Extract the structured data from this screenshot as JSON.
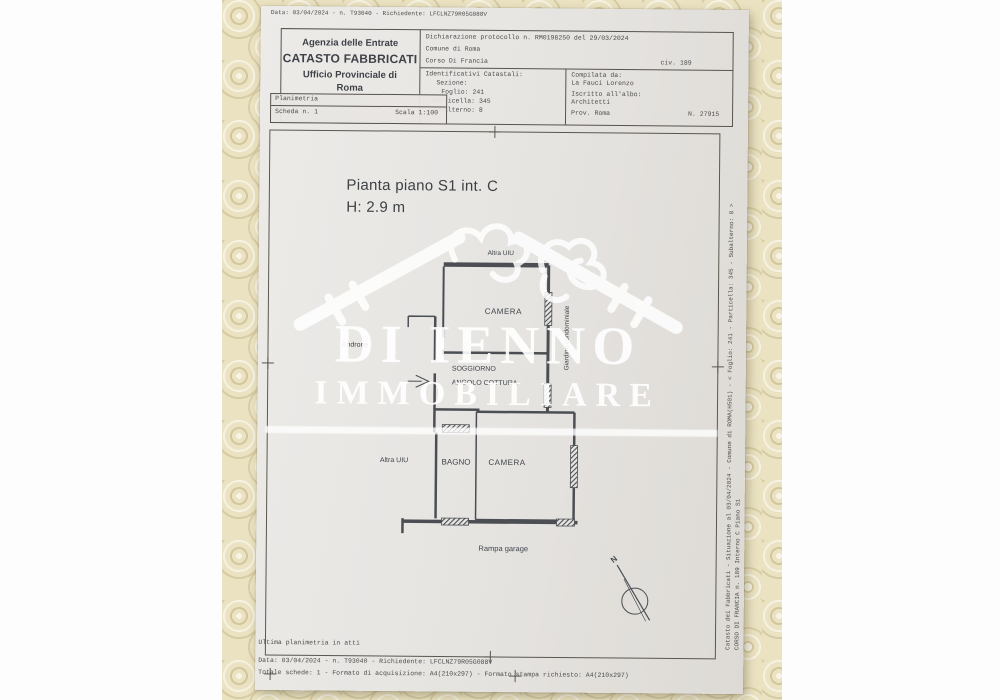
{
  "document": {
    "top_line": "Data: 03/04/2024 - n. T93040 - Richiedente: LFCLNZ79R05G088V",
    "header": {
      "agency_line1": "Agenzia delle Entrate",
      "agency_line2": "CATASTO FABBRICATI",
      "agency_line3": "Ufficio Provinciale di",
      "agency_line4": "Roma",
      "declaration": "Dichiarazione protocollo n. RM0198250 del 29/03/2024",
      "comune": "Comune di Roma",
      "street": "Corso Di Francia",
      "civic": "civ. 189",
      "cadastral_title": "Identificativi Catastali:",
      "sezione": "Sezione:",
      "foglio": "Foglio: 241",
      "particella": "Particella: 345",
      "subalterno": "Subalterno: 8",
      "compiled_title": "Compilata da:",
      "compiled_name": "La Fauci Lorenzo",
      "albo_label": "Iscritto all'albo:",
      "albo_value": "Architetti",
      "prov": "Prov. Roma",
      "reg_number": "N. 27915",
      "planimetria": "Planimetria",
      "scheda": "Scheda n. 1",
      "scala": "Scala 1:100"
    },
    "plan": {
      "title": "Pianta piano S1 int. C",
      "height": "H: 2.9 m",
      "rooms": {
        "altra_uiu_top": "Altra UIU",
        "camera_top": "CAMERA",
        "androne": "Androne",
        "soggiorno_line1": "SOGGIORNO",
        "soggiorno_line2": "ANGOLO COTTURA",
        "giardino": "Giardino condominiale",
        "altra_uiu_bottom": "Altra UIU",
        "bagno": "BAGNO",
        "camera_bottom": "CAMERA",
        "rampa_garage": "Rampa garage"
      },
      "north_label": "N"
    },
    "watermark": {
      "name": "DI IENNO",
      "subtitle": "IMMOBILIARE"
    },
    "side_text": {
      "line1": "Catasto dei Fabbricati - Situazione al 03/04/2024 - Comune di ROMA(H501) - < Foglio: 241 - Particella: 345 - Subalterno: 8 >",
      "line2": "CORSO DI FRANCIA n. 189  Interno C Piano S1"
    },
    "footer": {
      "line1": "Ultima planimetria in atti",
      "line2": "Data: 03/04/2024 - n. T93040 - Richiedente: LFCLNZ79R05G088V",
      "line3": "Totale schede: 1 - Formato di acquisizione: A4(210x297) - Formato stampa richiesto: A4(210x297)"
    },
    "colors": {
      "paper": "#e8e6e3",
      "ink": "#4a4e54",
      "tablecloth": "#eae2c1",
      "watermark": "#ffffff"
    }
  }
}
